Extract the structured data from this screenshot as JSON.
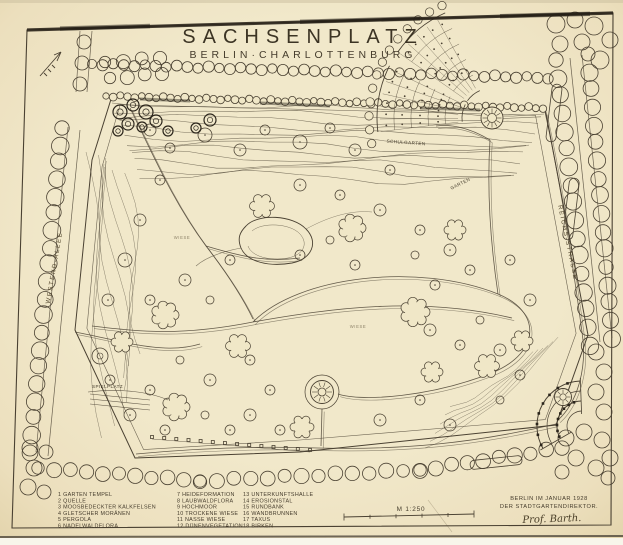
{
  "title": "SACHSENPLATZ",
  "subtitle": "BERLIN·CHARLOTTENBURG",
  "streets": {
    "left": "WESTEND-ALLEE",
    "right": "REICHS-STRASSE"
  },
  "plan_labels": {
    "schulgarten": "SCHULGARTEN",
    "garten": "GARTEN",
    "spielplatz": "SPIELPLATZ",
    "wiese_west": "WIESE",
    "wiese_center": "WIESE"
  },
  "legend": {
    "columns": [
      {
        "items": [
          "1 GARTEN TEMPEL",
          "2 QUELLE",
          "3 MOOSBEDECKTER KALKFELSEN",
          "4 GLETSCHER MORÄNEN",
          "5 PERGOLA",
          "6 NADELWALDFLORA"
        ]
      },
      {
        "items": [
          "7 HEIDEFORMATION",
          "8 LAUBWALDFLORA",
          "9 HOCHMOOR",
          "10 TROCKENE WIESE",
          "11 NASSE WIESE",
          "12 DÜNENVEGETATION"
        ]
      },
      {
        "items": [
          "13 UNTERKUNFTSHALLE",
          "14 EROSIONSTAL",
          "15 RUNDBANK",
          "16 WANDBRUNNEN",
          "17 TAXUS",
          "18 BIRKEN"
        ]
      }
    ]
  },
  "scale": {
    "label": "M 1:250"
  },
  "credit": {
    "line1": "BERLIN IM JANUAR 1928",
    "line2": "DER STADTGARTENDIREKTOR.",
    "signature": "Prof. Barth."
  },
  "colors": {
    "paper": "#f0e7c7",
    "ink": "#4a4132",
    "ink_dark": "#2b251b"
  }
}
